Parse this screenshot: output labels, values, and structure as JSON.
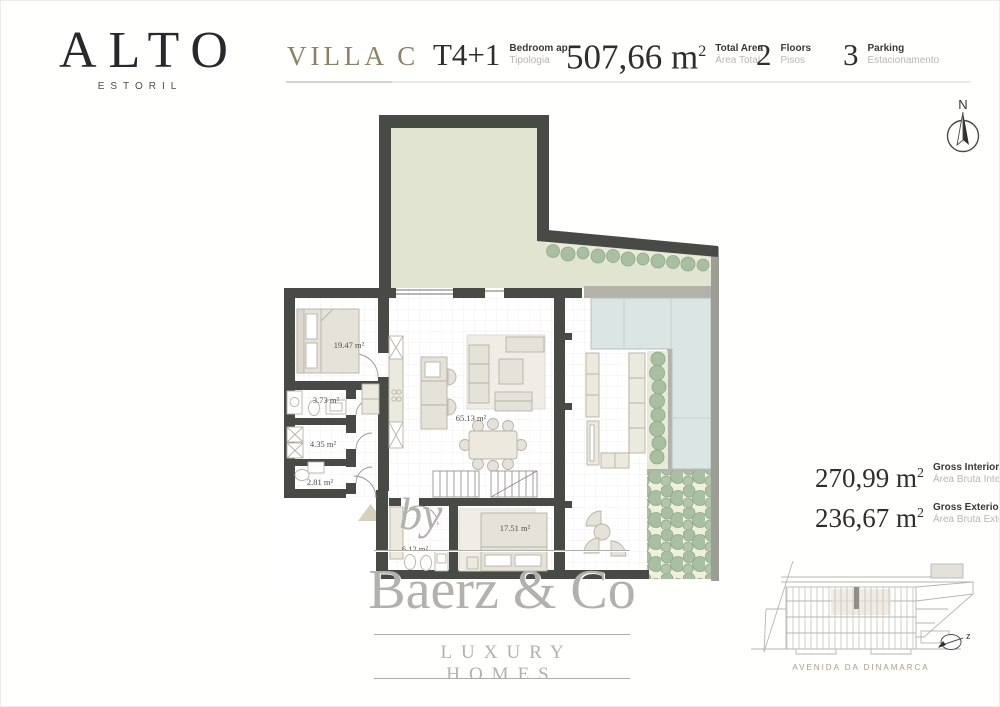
{
  "brand": {
    "name": "ALTO",
    "location": "ESTORIL"
  },
  "header": {
    "villa_name": "VILLA C",
    "stats": [
      {
        "value": "T4+1",
        "label_en": "Bedroom ap.",
        "label_pt": "Tipologia"
      },
      {
        "value": "507,66",
        "unit": "m",
        "sup": "2",
        "label_en": "Total Area",
        "label_pt": "Área Total"
      },
      {
        "value": "2",
        "label_en": "Floors",
        "label_pt": "Pisos"
      },
      {
        "value": "3",
        "label_en": "Parking",
        "label_pt": "Estacionamento"
      }
    ]
  },
  "compass": {
    "north_label": "N",
    "section_label": "z"
  },
  "floor_plan": {
    "room_labels": [
      {
        "text": "19.47 m²"
      },
      {
        "text": "3.73 m²"
      },
      {
        "text": "4.35 m²"
      },
      {
        "text": "2.81 m²"
      },
      {
        "text": "65.13 m²"
      },
      {
        "text": "6.12 m²"
      },
      {
        "text": "17.51 m²"
      }
    ]
  },
  "area_summary": [
    {
      "value": "270,99",
      "unit": "m",
      "sup": "2",
      "label_en": "Gross Interior Area",
      "label_pt": "Área Bruta Interior"
    },
    {
      "value": "236,67",
      "unit": "m",
      "sup": "2",
      "label_en": "Gross Exterior Area",
      "label_pt": "Área Bruta Exterior"
    }
  ],
  "watermark": {
    "prefix": "by",
    "name": "Baerz & Co",
    "tagline": "LUXURY HOMES"
  },
  "site_sketch": {
    "street_name": "AVENIDA DA DINAMARCA"
  },
  "colors": {
    "accent_tan": "#8d8167",
    "wall_dark": "#484a45",
    "garden_green": "#e0e4d0",
    "bush_green": "#a9bfa1",
    "pool_blue": "#dbe5e4",
    "deck_gray": "#b2b2aa",
    "watermark_gray": "#b3b1ac"
  }
}
